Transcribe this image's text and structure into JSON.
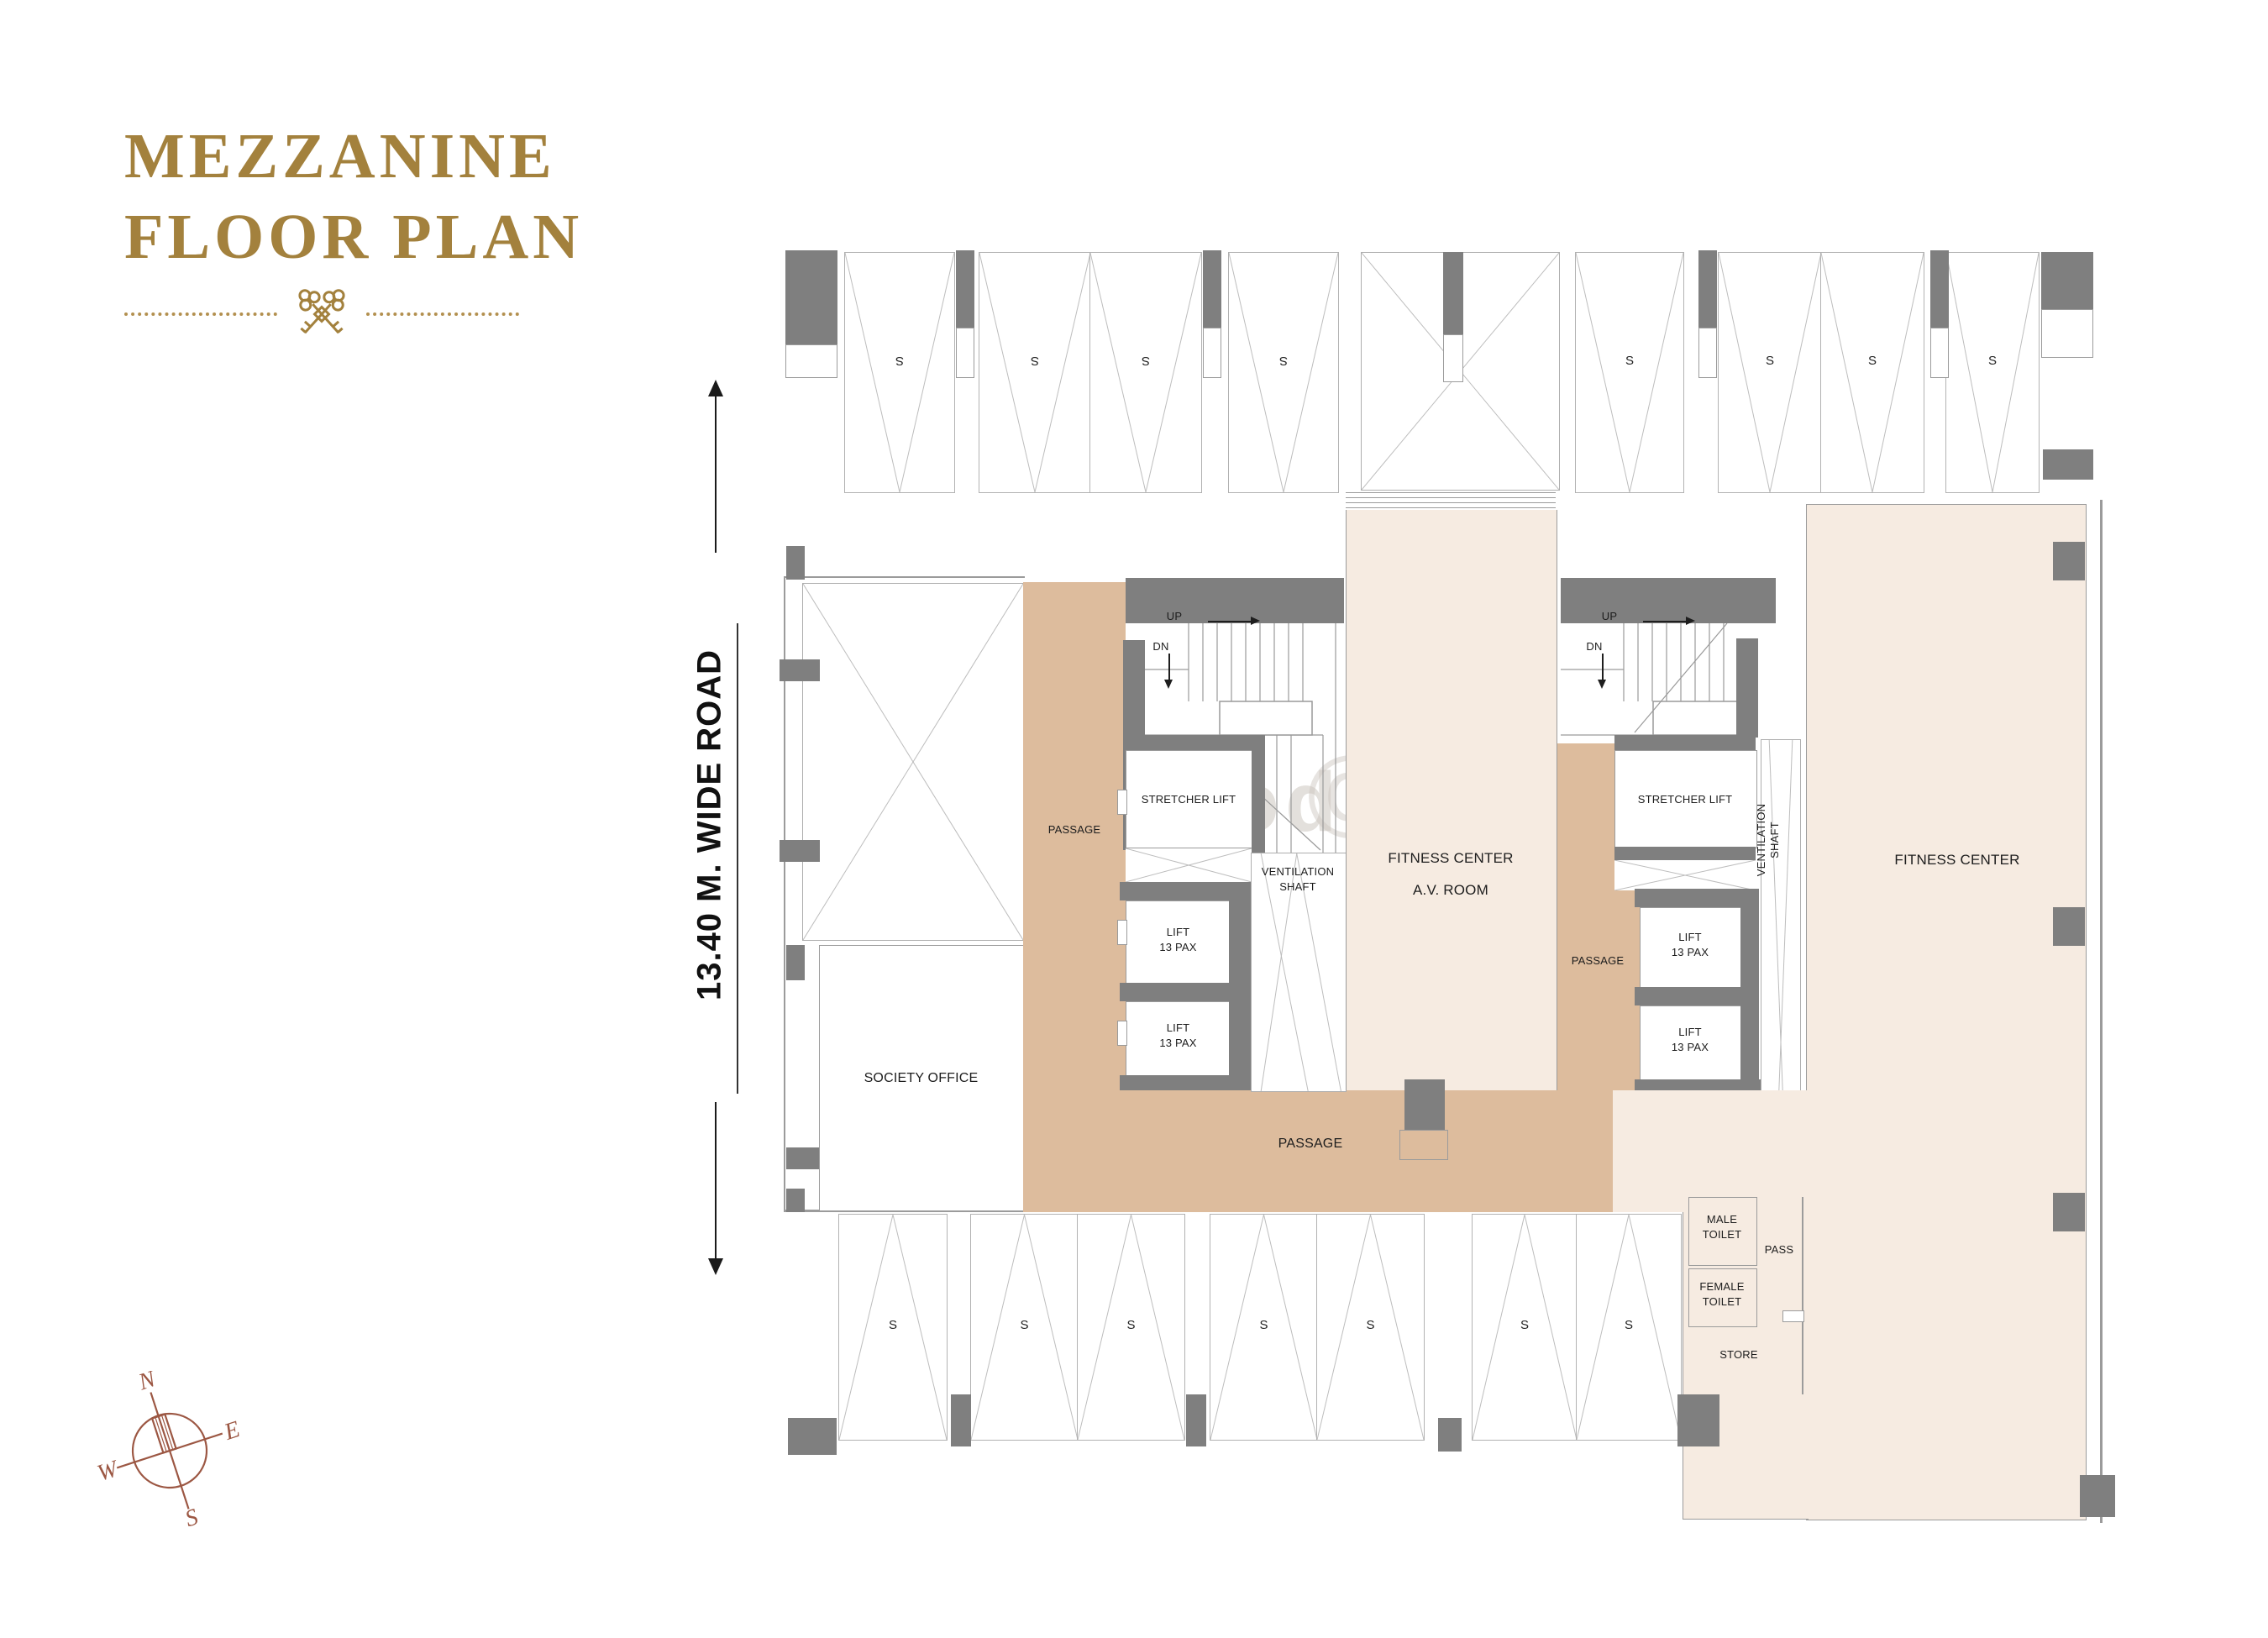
{
  "title": {
    "line1": "MEZZANINE",
    "line2": "FLOOR PLAN"
  },
  "dimension": {
    "road": "13.40 M. WIDE ROAD"
  },
  "compass": {
    "north": "N",
    "east": "E",
    "south": "S",
    "west": "W"
  },
  "watermark": {
    "text": "me Abod",
    "symbol": "©"
  },
  "labels": {
    "up": "UP",
    "dn": "DN",
    "stall": "S",
    "passage": "PASSAGE",
    "stretcher_lift": "STRETCHER LIFT",
    "lift1": "LIFT",
    "lift2": "13 PAX",
    "vent1": "VENTILATION",
    "vent2": "SHAFT",
    "av1": "FITNESS CENTER",
    "av2": "A.V. ROOM",
    "fitness": "FITNESS CENTER",
    "society": "SOCIETY OFFICE",
    "male1": "MALE",
    "male2": "TOILET",
    "female1": "FEMALE",
    "female2": "TOILET",
    "pass": "PASS",
    "store": "STORE"
  },
  "colors": {
    "accent_gold": "#a3813d",
    "wall_gray": "#7f7f7f",
    "room_cream": "#f6ebe1",
    "passage_tan": "#ddbc9d",
    "compass_sienna": "#9c5743",
    "outline_gray": "#9b9b9b"
  }
}
